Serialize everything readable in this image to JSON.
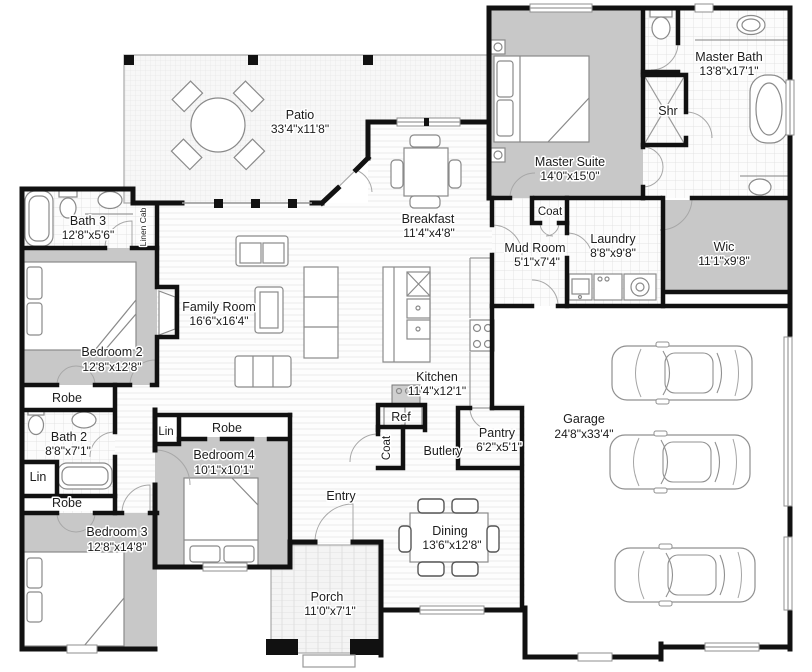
{
  "rooms": {
    "patio": {
      "name": "Patio",
      "dims": "33'4\"x11'8\""
    },
    "bath3": {
      "name": "Bath 3",
      "dims": "12'8\"x5'6\""
    },
    "linen_cab": {
      "name": "Linen Cab"
    },
    "bedroom2": {
      "name": "Bedroom 2",
      "dims": "12'8\"x12'8\""
    },
    "robe1": {
      "name": "Robe"
    },
    "bath2": {
      "name": "Bath 2",
      "dims": "8'8\"x7'1\""
    },
    "lin1": {
      "name": "Lin"
    },
    "robe2": {
      "name": "Robe"
    },
    "bedroom3": {
      "name": "Bedroom 3",
      "dims": "12'8\"x14'8\""
    },
    "lin2": {
      "name": "Lin"
    },
    "robe3": {
      "name": "Robe"
    },
    "bedroom4": {
      "name": "Bedroom 4",
      "dims": "10'1\"x10'1\""
    },
    "family_room": {
      "name": "Family Room",
      "dims": "16'6\"x16'4\""
    },
    "breakfast": {
      "name": "Breakfast",
      "dims": "11'4\"x4'8\""
    },
    "kitchen": {
      "name": "Kitchen",
      "dims": "11'4\"x12'1\""
    },
    "ref": {
      "name": "Ref"
    },
    "coat_entry": {
      "name": "Coat"
    },
    "butlery": {
      "name": "Butlery"
    },
    "pantry": {
      "name": "Pantry",
      "dims": "6'2\"x5'1\""
    },
    "entry": {
      "name": "Entry"
    },
    "dining": {
      "name": "Dining",
      "dims": "13'6\"x12'8\""
    },
    "porch": {
      "name": "Porch",
      "dims": "11'0\"x7'1\""
    },
    "master_suite": {
      "name": "Master Suite",
      "dims": "14'0\"x15'0\""
    },
    "master_bath": {
      "name": "Master Bath",
      "dims": "13'8\"x17'1\""
    },
    "shower": {
      "name": "Shr"
    },
    "coat_master": {
      "name": "Coat"
    },
    "mud_room": {
      "name": "Mud Room",
      "dims": "5'1\"x7'4\""
    },
    "laundry": {
      "name": "Laundry",
      "dims": "8'8\"x9'8\""
    },
    "wic": {
      "name": "Wic",
      "dims": "11'1\"x9'8\""
    },
    "garage": {
      "name": "Garage",
      "dims": "24'8\"x33'4\""
    }
  },
  "colors": {
    "wall": "#111111",
    "room_fill": "#c8c8c8",
    "furniture": "#8a8a8a"
  }
}
